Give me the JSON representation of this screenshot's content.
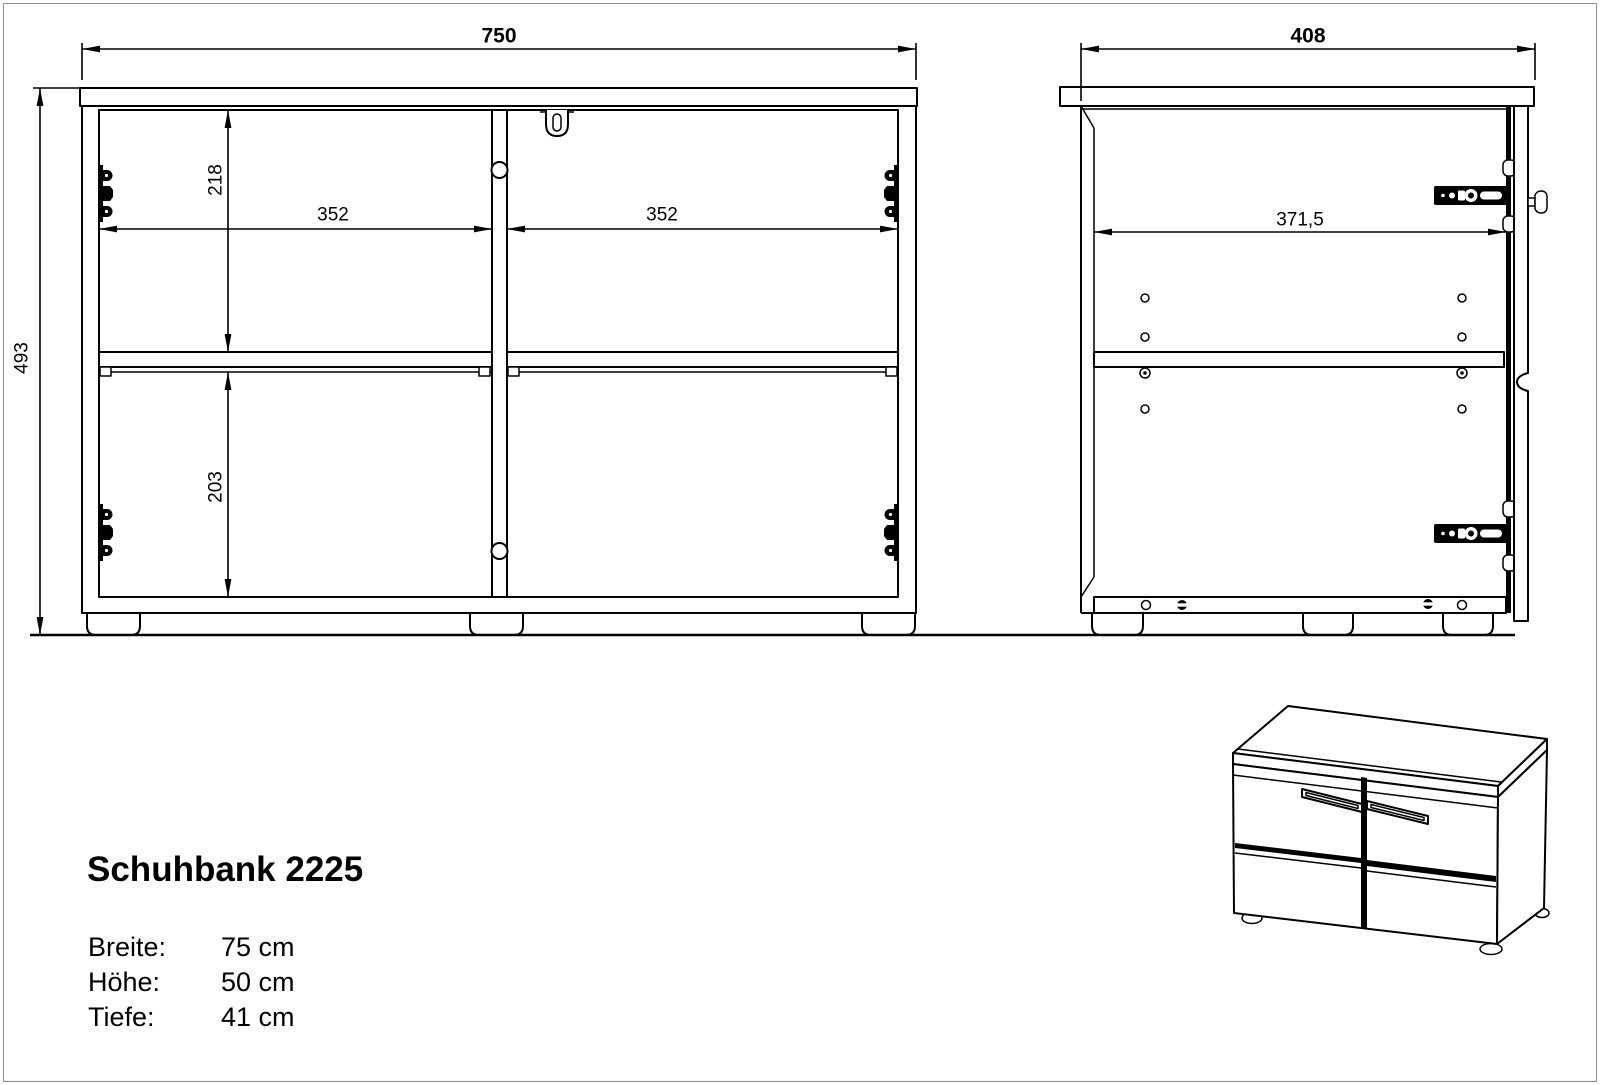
{
  "sheet": {
    "background": "#ffffff",
    "frame_color": "#8f8f8f",
    "line_color": "#000000"
  },
  "product": {
    "title": "Schuhbank 2225",
    "specs": [
      {
        "label": "Breite:",
        "value": "75 cm"
      },
      {
        "label": "Höhe:",
        "value": "50 cm"
      },
      {
        "label": "Tiefe:",
        "value": "41 cm"
      }
    ]
  },
  "front_view": {
    "overall_width_mm": "750",
    "overall_height_mm": "493",
    "upper_inner_height_mm": "218",
    "lower_inner_height_mm": "203",
    "left_compartment_width_mm": "352",
    "right_compartment_width_mm": "352"
  },
  "side_view": {
    "overall_depth_mm": "408",
    "inner_depth_mm": "371,5"
  }
}
